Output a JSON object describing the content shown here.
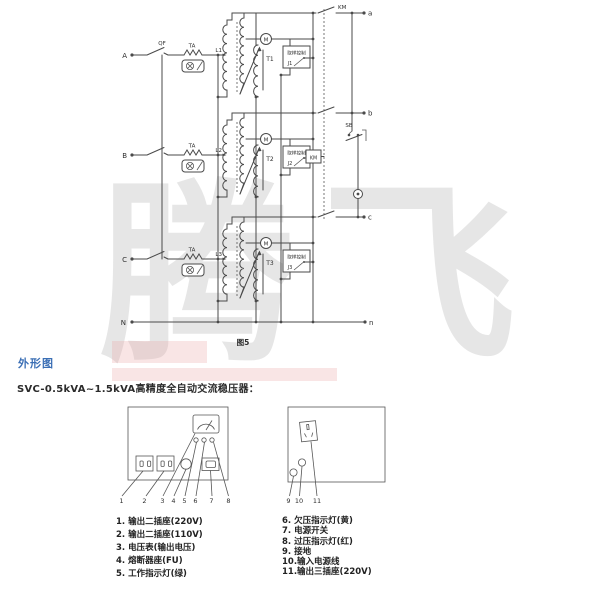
{
  "watermark": {
    "text": "腾飞"
  },
  "circuit": {
    "caption": "图5",
    "neutral_in": "N",
    "neutral_out": "n",
    "contactor_label": "KM",
    "contactor_coil": "KM",
    "button": "SB",
    "phases": [
      {
        "input": "A",
        "breaker": "QF",
        "ct": "TA",
        "winding": "L1",
        "transformer": "T1",
        "motor": "M",
        "controller": "取样控制",
        "relay": "J1",
        "output": "a"
      },
      {
        "input": "B",
        "breaker": "",
        "ct": "TA",
        "winding": "L2",
        "transformer": "T2",
        "motor": "M",
        "controller": "取样控制",
        "relay": "J2",
        "output": "b"
      },
      {
        "input": "C",
        "breaker": "",
        "ct": "TA",
        "winding": "L3",
        "transformer": "T3",
        "motor": "M",
        "controller": "取样控制",
        "relay": "J3",
        "output": "c"
      }
    ]
  },
  "section": {
    "heading": "外形图",
    "subtitle": "SVC-0.5kVA~1.5kVA高精度全自动交流稳压器："
  },
  "panels": {
    "front_callouts": [
      "1",
      "2",
      "3",
      "4",
      "5",
      "6",
      "7",
      "8"
    ],
    "rear_callouts": [
      "9",
      "10",
      "11"
    ]
  },
  "legend": {
    "left": [
      "1. 输出二插座(220V)",
      "2. 输出二插座(110V)",
      "3. 电压表(输出电压)",
      "4. 熔断器座(FU)",
      "5. 工作指示灯(绿)"
    ],
    "right": [
      "6. 欠压指示灯(黄)",
      "7. 电源开关",
      "8. 过压指示灯(红)",
      "9. 接地",
      "10.输入电源线",
      "11.输出三插座(220V)"
    ]
  }
}
